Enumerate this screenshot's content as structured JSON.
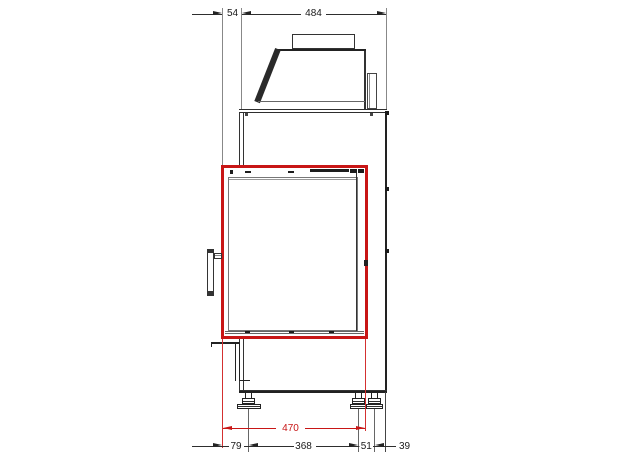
{
  "drawing": {
    "kind": "fireplace-insert-side-elevation",
    "colors": {
      "highlight_red": "#c81616",
      "line_dark": "#2e2e2e",
      "background": "#ffffff"
    }
  },
  "dims": {
    "top_54": "54",
    "top_484": "484",
    "door_470": "470",
    "bottom_79": "79",
    "bottom_368": "368",
    "bottom_51": "51",
    "bottom_39": "39"
  }
}
